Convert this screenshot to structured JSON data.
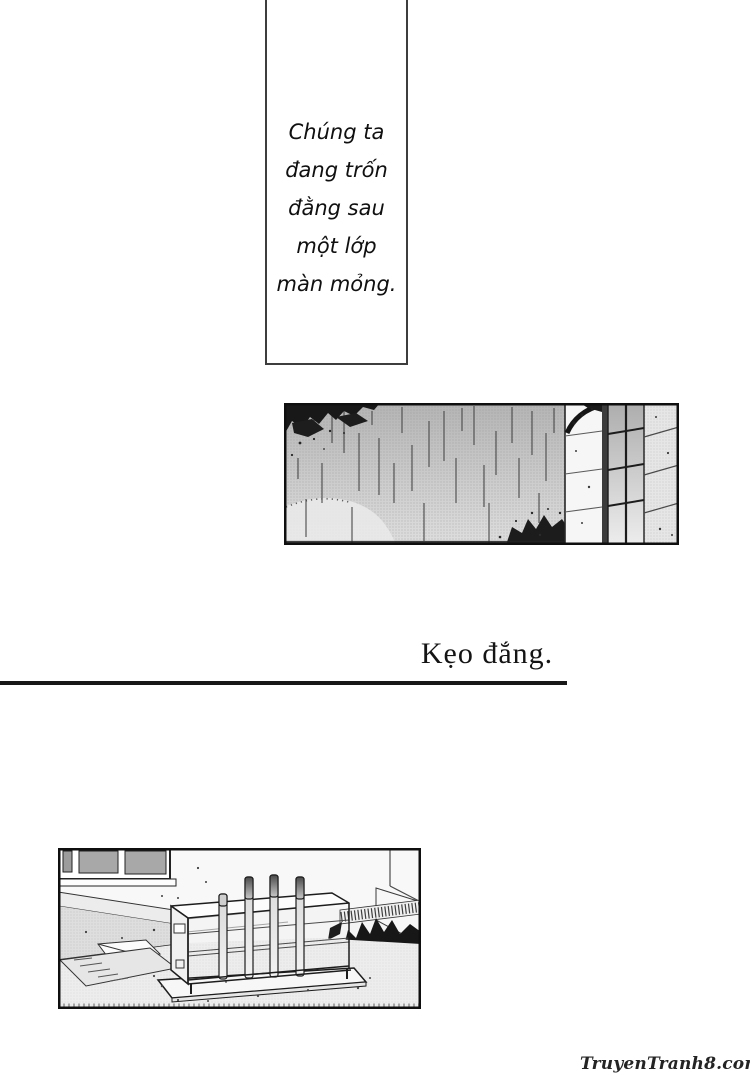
{
  "speech_panel": {
    "lines": [
      "Chúng ta",
      "đang trốn",
      "đằng sau",
      "một lớp",
      "màn mỏng."
    ]
  },
  "caption": {
    "title": "Kẹo đắng."
  },
  "watermark": {
    "text": "TruyenTranh8.com"
  },
  "art": {
    "rain_panel": "rain-falling-past-stone-wall-and-window",
    "yard_panel": "outdoor-rack-with-four-tubes-by-wall-and-plants"
  },
  "colors": {
    "ink": "#121212",
    "paper": "#ffffff",
    "halftone_dark": "#b9b9b9",
    "halftone_light": "#e4e4e4"
  }
}
